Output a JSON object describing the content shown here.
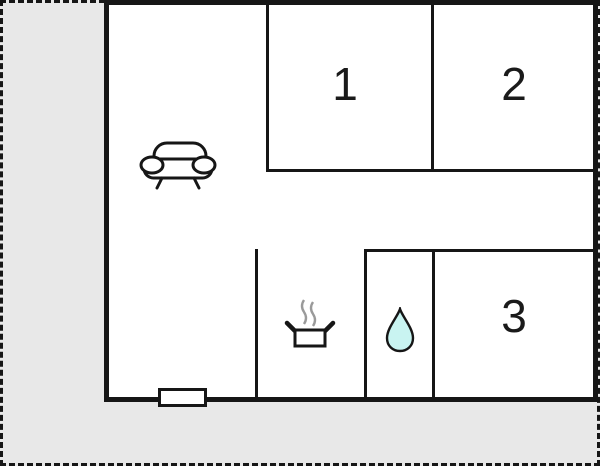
{
  "plan": {
    "rooms": [
      {
        "label": "1"
      },
      {
        "label": "2"
      },
      {
        "label": "3"
      }
    ],
    "icons": {
      "living_area": "sofa-icon",
      "kitchen": "cooking-pot-icon",
      "bathroom": "water-drop-icon",
      "entrance": "door-symbol"
    },
    "colors": {
      "wall": "#161616",
      "outdoor_area": "#e8e8e8",
      "floor": "#ffffff",
      "water_drop": "#c9f4f1",
      "steam": "#9a9a9a"
    }
  }
}
